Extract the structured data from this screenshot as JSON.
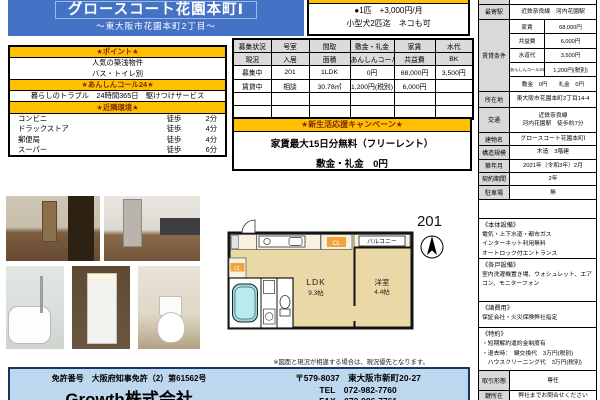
{
  "colors": {
    "accent_blue": "#4472C4",
    "accent_orange": "#FFC000",
    "orange_header_text": "#7F2B00",
    "company_box_bg": "#BDD7EE",
    "label_cell_gray": "#D9D9D9",
    "plan_room_tan": "#EAD9A6",
    "plan_tub_cyan": "#93DBE3"
  },
  "header": {
    "title": "グロースコート花園本町Ⅰ",
    "subtitle": "〜東大阪市花園本町2丁目〜"
  },
  "pet_box": {
    "line1": "●1匹　+3,000円/月",
    "line2": "小型犬2匹迄　ネコも可"
  },
  "points": {
    "title_point": "★ポイント★",
    "point1": "人気の築浅物件",
    "point2": "バス・トイレ別",
    "title_anshin": "★あんしんコール24★",
    "anshin1": "暮らしのトラブル　24時間365日　駆けつけサービス",
    "title_env": "★近隣環境★",
    "env": [
      {
        "name": "コンビニ",
        "walk": "徒歩",
        "time": "2分"
      },
      {
        "name": "ドラックストア",
        "walk": "徒歩",
        "time": "4分"
      },
      {
        "name": "郵便局",
        "walk": "徒歩",
        "time": "4分"
      },
      {
        "name": "スーパー",
        "walk": "徒歩",
        "time": "6分"
      }
    ]
  },
  "unit_table": {
    "header1": [
      "募集状況",
      "号室",
      "間取",
      "敷金・礼金",
      "家賃",
      "水代"
    ],
    "header2": [
      "現況",
      "入居",
      "面積",
      "あんしんコール24",
      "共益費",
      "BK"
    ],
    "rows": [
      [
        "募集中",
        "201",
        "1LDK",
        "0円",
        "68,000円",
        "3,500円"
      ],
      [
        "賃貸中",
        "相談",
        "30.78㎡",
        "1,200円(税別)",
        "6,000円",
        ""
      ],
      [
        "",
        "",
        "",
        "",
        "",
        ""
      ],
      [
        "",
        "",
        "",
        "",
        "",
        ""
      ]
    ]
  },
  "campaign": {
    "title": "★新生活応援キャンペーン★",
    "line1": "家賃最大15日分無料（フリーレント）",
    "line2": "敷金・礼金　0円"
  },
  "floorplan": {
    "room_no": "201",
    "ldk": "LDK",
    "ldk_size": "9.3帖",
    "bedroom": "洋室",
    "bedroom_size": "4.4帖",
    "balcony": "バルコニー",
    "closet": "CL"
  },
  "photos": {
    "items": [
      "living-room",
      "kitchen",
      "bathroom",
      "washstand",
      "toilet"
    ]
  },
  "disclaimer": "※図面と現況が相違する場合は、現況優先となります。",
  "detail": {
    "station_label": "最寄駅",
    "station_value": "近鉄奈良線　河内花園駅",
    "terms_label": "賃貸条件",
    "terms": [
      [
        "家賃",
        "68,000円"
      ],
      [
        "共益費",
        "6,000円"
      ],
      [
        "水道代",
        "3,500円"
      ],
      [
        "あんしんコール24",
        "1,200円(税別)"
      ]
    ],
    "terms_last": "敷金　0円　　礼金　0円",
    "rows": [
      {
        "label": "所在地",
        "value": "東大阪市花園本町2丁目14-4"
      },
      {
        "label": "建物名",
        "value": "グロースコート花園本町Ⅰ"
      },
      {
        "label": "構造規模",
        "value": "木造　3階建"
      },
      {
        "label": "築年月",
        "value": "2021年（令和3年）2月"
      },
      {
        "label": "契約期間",
        "value": "2年"
      },
      {
        "label": "駐車場",
        "value": "無"
      }
    ],
    "kotsu_label": "交通",
    "kotsu1": "近鉄奈良線",
    "kotsu2": "河内花園駅　徒歩約7分",
    "equip_main_title": "《本体設備》",
    "equip_main": [
      "電気・上下水道・都市ガス",
      "インターネット利用無料",
      "オートロック付エントランス"
    ],
    "equip_unit_title": "《各戸設備》",
    "equip_unit": "室内洗濯機置き場、ウォシュレット、エアコン、モニターフォン",
    "fees_title": "《諸費用》",
    "fees": "保証会社・火災保険弊社指定",
    "tokuyaku_title": "《特約》",
    "tokuyaku": [
      "・短期解約違約金制度有",
      "・退去時：　鍵交換代　3万円(税別)",
      "　ハウスクリーニング代　3万円(税別)"
    ],
    "deal_label": "取引形態",
    "deal_value": "専任",
    "key_label": "鍵所在",
    "key_value": "弊社までお問合せください"
  },
  "company": {
    "license": "免許番号　大阪府知事免許（2）第61562号",
    "name": "Growth株式会社",
    "address": "〒579-8037　東大阪市新町20-27",
    "tel": "TEL　072-982-7760",
    "fax": "FAX　072-986-7761"
  }
}
